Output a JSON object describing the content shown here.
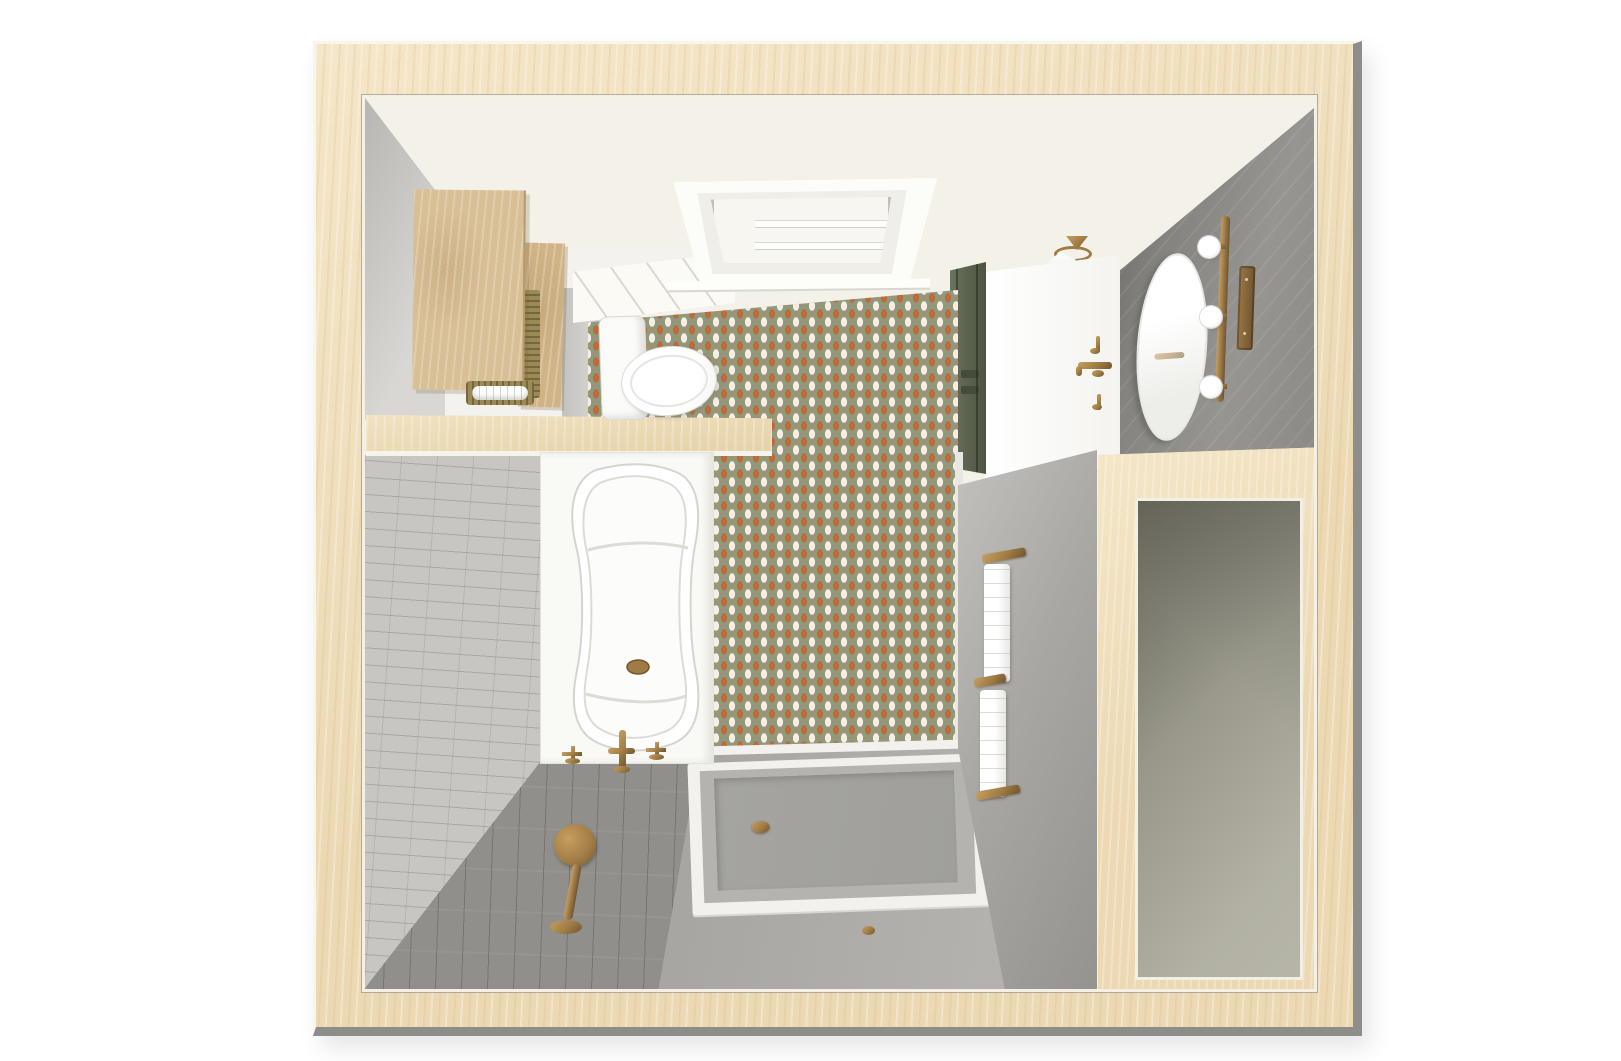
{
  "scene": {
    "description": "Top-down 3D dollhouse rendering of a bathroom floor plan inside a light wood cutaway frame",
    "room_type": "bathroom",
    "view": "overhead cutaway render",
    "objects": [
      {
        "id": "cutaway-wood-frame",
        "label": "light maple cutaway wall frame"
      },
      {
        "id": "ceiling",
        "label": "cream ceiling"
      },
      {
        "id": "skylight",
        "label": "recessed white skylight"
      },
      {
        "id": "ceiling-lamp",
        "label": "brass ceiling lamp with white shade"
      },
      {
        "id": "wall-cabinets",
        "label": "two tall light-wood cabinets"
      },
      {
        "id": "towel-basket",
        "label": "woven basket with rolled white towel"
      },
      {
        "id": "toilet",
        "label": "white toilet, tank and oval seat"
      },
      {
        "id": "mosaic-tile-wall",
        "label": "orange, sage-green and white picket mosaic wall"
      },
      {
        "id": "pony-wall-cap",
        "label": "wood-capped half wall"
      },
      {
        "id": "bathtub",
        "label": "white alcove bathtub with brass drain"
      },
      {
        "id": "tub-filler",
        "label": "floor-mounted brass tub filler with cross handles"
      },
      {
        "id": "hand-shower",
        "label": "brass handheld shower on brick wall"
      },
      {
        "id": "brick-tile-wall",
        "label": "light gray brick tile wall"
      },
      {
        "id": "plank-floor",
        "label": "gray wood-plank floor"
      },
      {
        "id": "shower-floor",
        "label": "gray shower zone floor"
      },
      {
        "id": "shower-pan",
        "label": "recessed gray shower pan with brass drain"
      },
      {
        "id": "partition-wall",
        "label": "gray shower partition wall"
      },
      {
        "id": "towel-ladder",
        "label": "brass rails with two hanging white towels"
      },
      {
        "id": "green-door",
        "label": "dark olive paneled door"
      },
      {
        "id": "vanity-wall",
        "label": "charcoal tiled vanity wall"
      },
      {
        "id": "vanity-faucet",
        "label": "wall-mounted brass faucet with cross handles"
      },
      {
        "id": "oval-mirror",
        "label": "oval vanity mirror"
      },
      {
        "id": "vanity-light-bar",
        "label": "brass light bar with three globe bulbs"
      },
      {
        "id": "switch-plate",
        "label": "brass wall plate"
      },
      {
        "id": "walk-in-closet",
        "label": "adjacent walk-in opening"
      }
    ]
  },
  "colors": {
    "bg": "#ffffff",
    "frame-wood": "#ecd9b4",
    "frame-wood-hi": "#f4e6c8",
    "trim-cream": "#f8f5e9",
    "edge-gray": "#8d8d8a",
    "ceiling": "#f3f1e8",
    "ceiling-bright": "#fbfaf5",
    "wall-gray-light": "#d8d7d4",
    "wall-gray-dark": "#b3b2af",
    "nook-white": "#f3f2ee",
    "vanity-wall": "#8a8985",
    "vanity-wall-dark": "#5f5e5a",
    "white-wall": "#fcfcfa",
    "brick": "#c7c6c2",
    "brick-line": "#a9a8a5",
    "plank-floor": "#908f8b",
    "plank-line": "#6f6e6a",
    "shower-floor": "#aeada9",
    "pan-rim": "#f2f1ee",
    "pan-curb": "#b4b3af",
    "pan-recess": "#a09f9b",
    "partition-light": "#c2c1bd",
    "partition-dark": "#949390",
    "tile-green": "#8d9a80",
    "tile-orange": "#c06a38",
    "tile-white": "#f4efe3",
    "tile-line": "#cd7a42",
    "door-green": "#5c6450",
    "door-green-dark": "#454c3a",
    "brass": "#a07c44",
    "brass-hi": "#c69e60",
    "brass-dark": "#6f5530",
    "towel-white": "#fdfdfb",
    "closet-light": "#b2b1a4",
    "closet-dark": "#7f7e71",
    "wood-cab": "#d8bf95",
    "wood-cab2": "#d0b488",
    "woven": "#9c8a56",
    "pure-white": "#ffffff"
  }
}
